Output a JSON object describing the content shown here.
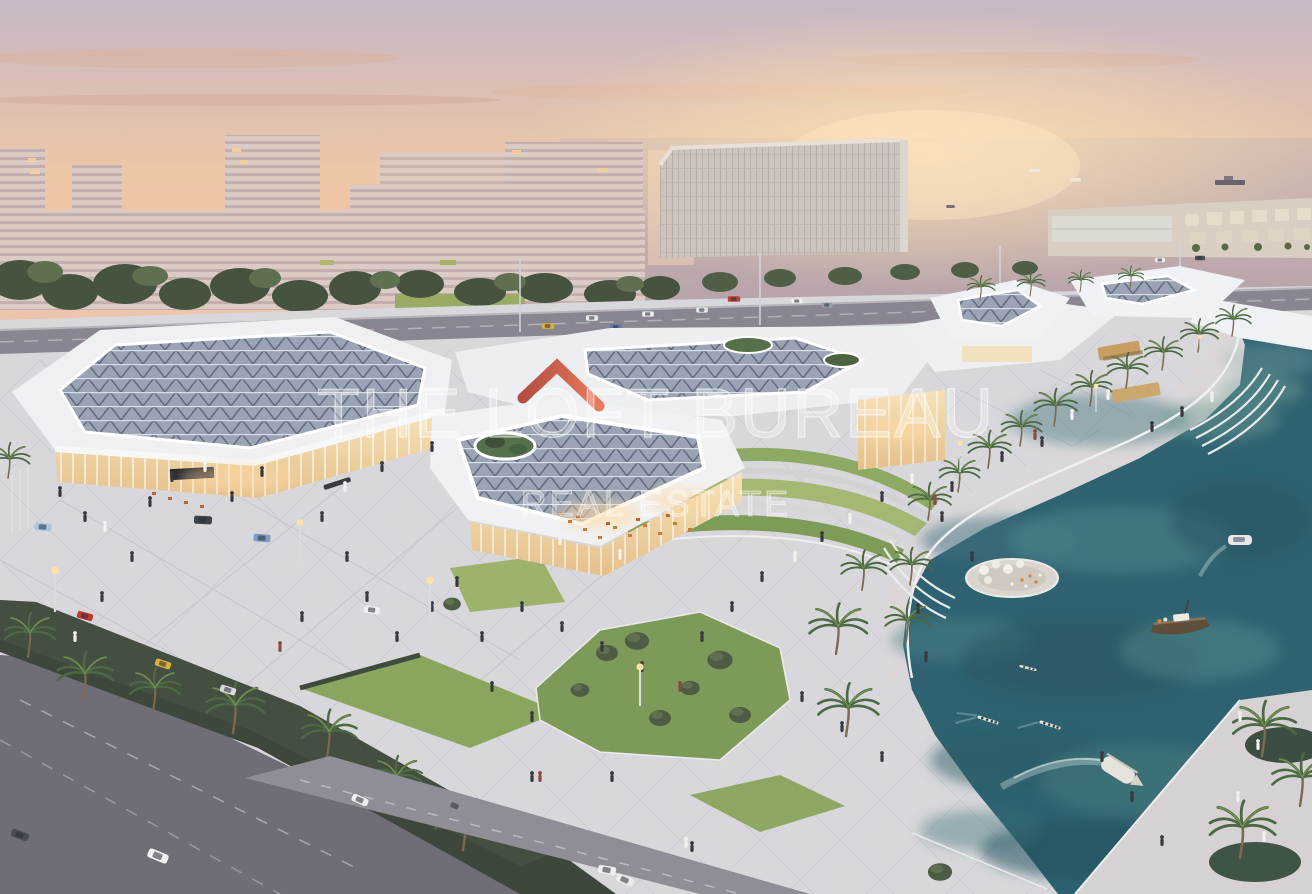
{
  "watermark": {
    "logo_icon": "roof-logo-icon",
    "title": "THE LOFT BUREAU",
    "subtitle": "REAL ESTATE",
    "text_color": "#ffffff",
    "logo_gradient_start": "#a93226",
    "logo_gradient_end": "#e8643f"
  },
  "scene": {
    "palette": {
      "sky_top": "#c5b8c6",
      "sunset_glow": "#f5d2a6",
      "sea": "#c3afae",
      "background_buildings": "#d8c7c1",
      "mall_roof": "#eef0f3",
      "skylight_glass": "#9aa4b4",
      "storefront_glow": "#f3dcae",
      "plaza": "#d8d7db",
      "lawn": "#92aa60",
      "asphalt": "#6f6d75",
      "hedge": "#3d473c",
      "canal_water": "#2e6271",
      "palm_frond": "#4d6844"
    }
  }
}
